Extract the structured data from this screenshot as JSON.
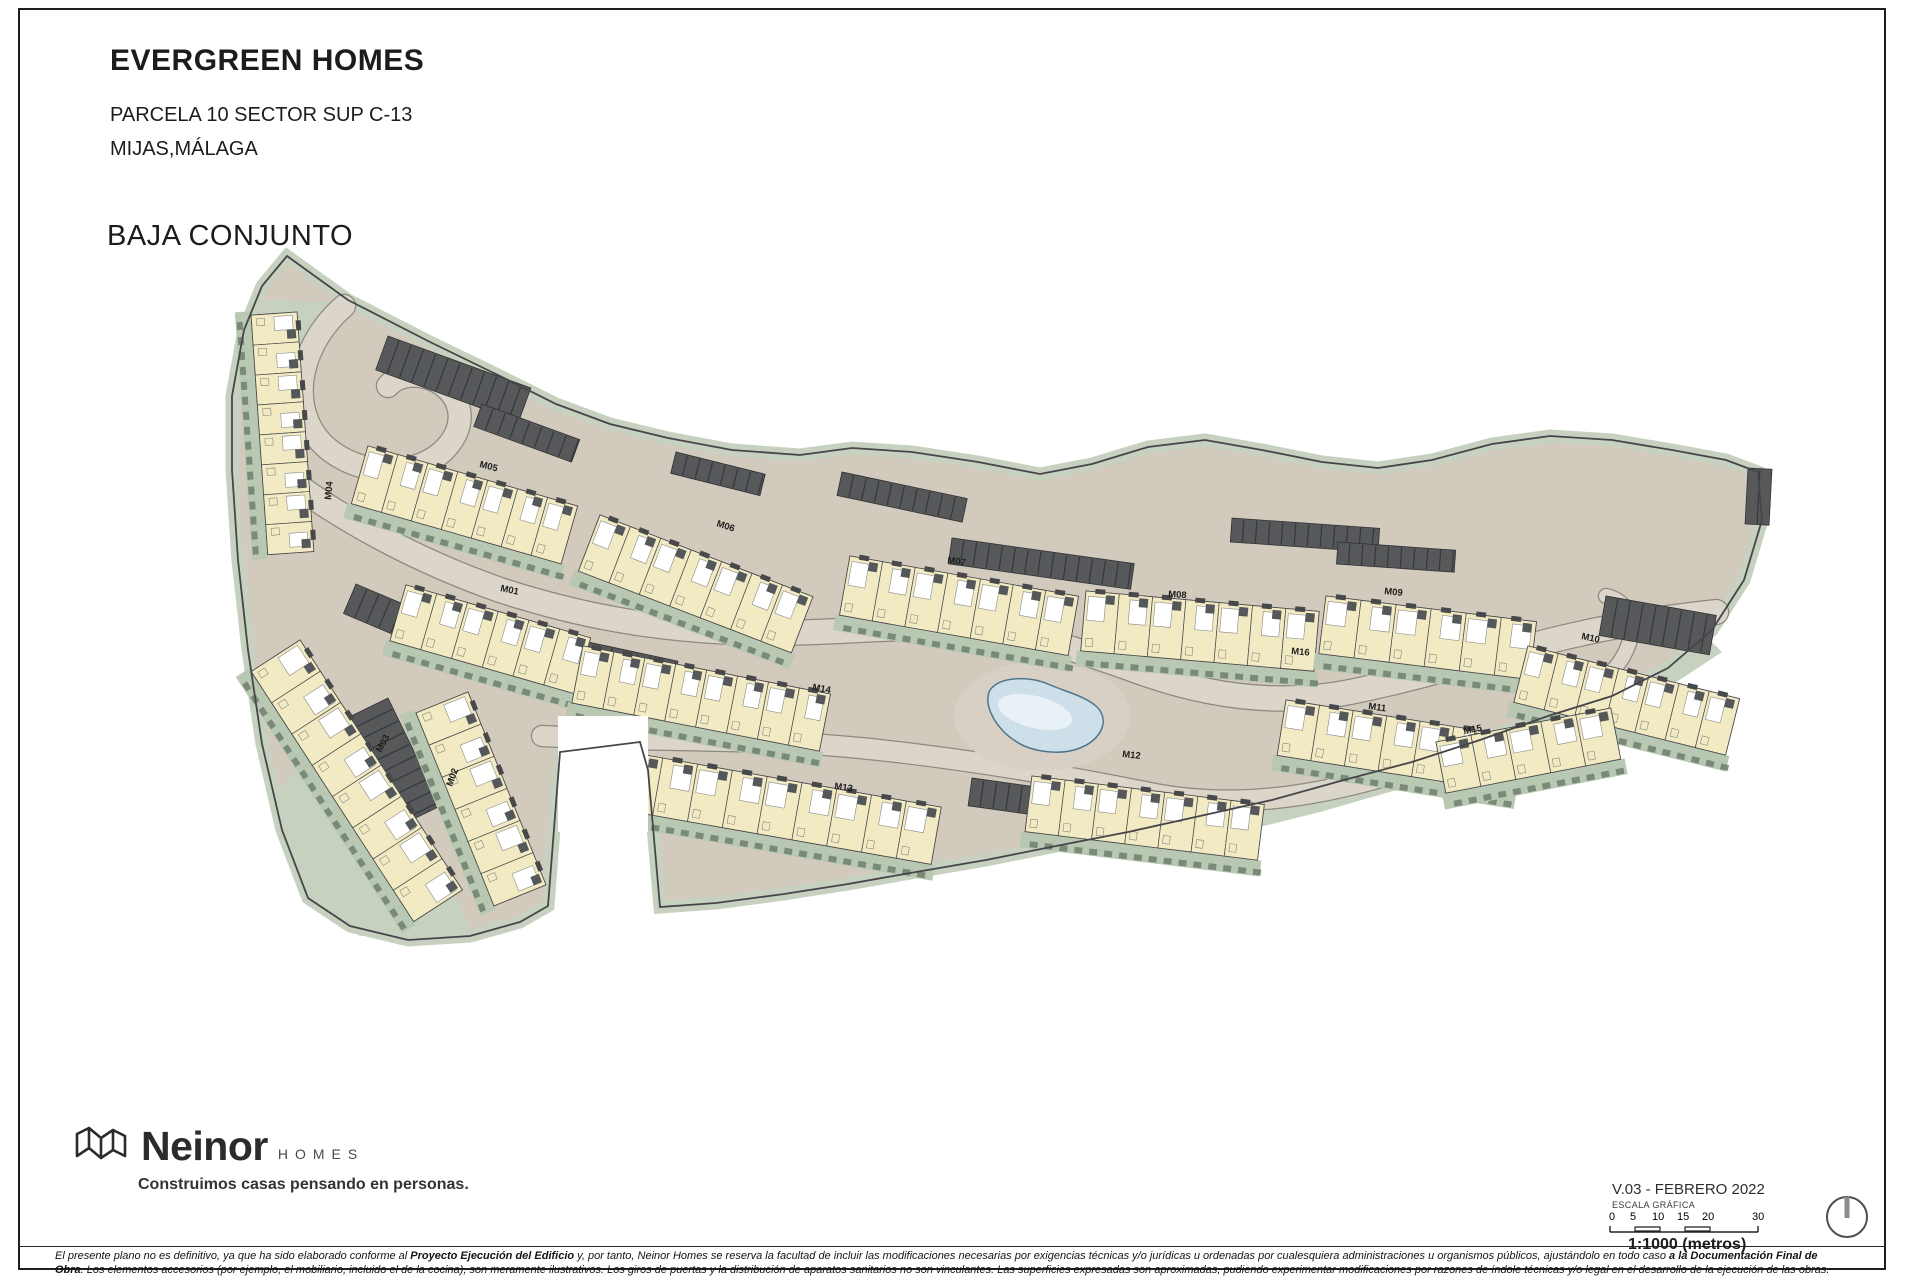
{
  "title_block": {
    "project": "EVERGREEN HOMES",
    "line1": "PARCELA 10 SECTOR SUP C-13",
    "line2": "MIJAS,MÁLAGA",
    "view": "BAJA CONJUNTO"
  },
  "footer": {
    "brand": "Neinor",
    "brand_sub": "HOMES",
    "tagline": "Construimos casas pensando en personas.",
    "version": "V.03 - FEBRERO 2022",
    "scale_title": "ESCALA GRÁFICA",
    "scale_marks": [
      "0",
      "5",
      "10",
      "15",
      "20",
      "30"
    ],
    "scale_ratio": "1:1000 (metros)",
    "compass_icon": "north-indicator"
  },
  "disclaimer": {
    "line1": [
      {
        "t": "El presente plano no es definitivo, ya que ha sido elaborado conforme al ",
        "b": false
      },
      {
        "t": "Proyecto Ejecución del Edificio",
        "b": true
      },
      {
        "t": " y, por tanto, Neinor Homes se reserva la facultad de incluir las modificaciones necesarias por exigencias técnicas y/o jurídicas u ordenadas por cualesquiera administraciones u organismos públicos, ajustándolo en todo caso ",
        "b": false
      },
      {
        "t": "a la Documentación Final de",
        "b": true
      }
    ],
    "line2": [
      {
        "t": "Obra",
        "b": true
      },
      {
        "t": ". Los elementos accesorios (por ejemplo, el mobiliario, incluido el de la cocina), son meramente ilustrativos. Los giros de puertas y la distribución de aparatos sanitarios no son vinculantes. Las superficies expresadas son aproximadas, pudiendo experimentar modificaciones por razones de índole técnicas y/o legal en el desarrollo de la ejecución de las obras.",
        "b": false
      }
    ]
  },
  "plan": {
    "colors": {
      "ground": "#d2cabd",
      "road": "#dcd5ca",
      "casing": "#8d897f",
      "green": "#b9c8b2",
      "green2": "#c6d2bf",
      "hedge": "#6f7f6d",
      "strip": "#fcfbf5",
      "unit": "#f1eac2",
      "line": "#46464a",
      "dark": "#56585a",
      "pool": "#cddfe9",
      "pool_edge": "#50758b"
    },
    "outline": [
      [
        287,
        256
      ],
      [
        348,
        300
      ],
      [
        430,
        342
      ],
      [
        500,
        376
      ],
      [
        556,
        404
      ],
      [
        610,
        424
      ],
      [
        668,
        438
      ],
      [
        732,
        450
      ],
      [
        800,
        455
      ],
      [
        852,
        448
      ],
      [
        912,
        452
      ],
      [
        978,
        462
      ],
      [
        1040,
        474
      ],
      [
        1092,
        464
      ],
      [
        1148,
        447
      ],
      [
        1205,
        440
      ],
      [
        1262,
        450
      ],
      [
        1322,
        462
      ],
      [
        1378,
        468
      ],
      [
        1432,
        460
      ],
      [
        1492,
        444
      ],
      [
        1550,
        436
      ],
      [
        1612,
        440
      ],
      [
        1672,
        450
      ],
      [
        1726,
        460
      ],
      [
        1758,
        472
      ],
      [
        1762,
        520
      ],
      [
        1744,
        580
      ],
      [
        1712,
        630
      ],
      [
        1668,
        668
      ],
      [
        1612,
        696
      ],
      [
        1548,
        716
      ],
      [
        1480,
        740
      ],
      [
        1412,
        762
      ],
      [
        1344,
        780
      ],
      [
        1272,
        800
      ],
      [
        1200,
        816
      ],
      [
        1128,
        832
      ],
      [
        1056,
        846
      ],
      [
        986,
        860
      ],
      [
        916,
        872
      ],
      [
        848,
        884
      ],
      [
        784,
        894
      ],
      [
        716,
        903
      ],
      [
        660,
        907
      ],
      [
        648,
        770
      ],
      [
        640,
        742
      ],
      [
        560,
        752
      ],
      [
        548,
        906
      ],
      [
        520,
        922
      ],
      [
        470,
        936
      ],
      [
        408,
        940
      ],
      [
        350,
        926
      ],
      [
        308,
        898
      ],
      [
        282,
        830
      ],
      [
        262,
        744
      ],
      [
        248,
        650
      ],
      [
        238,
        560
      ],
      [
        232,
        470
      ],
      [
        232,
        396
      ],
      [
        244,
        330
      ],
      [
        262,
        286
      ]
    ],
    "green_patches": [
      [
        [
          266,
          300
        ],
        [
          332,
          302
        ],
        [
          302,
          354
        ],
        [
          252,
          338
        ]
      ],
      [
        [
          300,
          762
        ],
        [
          420,
          820
        ],
        [
          470,
          930
        ],
        [
          360,
          936
        ],
        [
          302,
          894
        ],
        [
          272,
          800
        ]
      ],
      [
        [
          1150,
          838
        ],
        [
          1300,
          800
        ],
        [
          1460,
          752
        ],
        [
          1590,
          706
        ],
        [
          1680,
          662
        ],
        [
          1706,
          636
        ],
        [
          1722,
          652
        ],
        [
          1640,
          706
        ],
        [
          1480,
          766
        ],
        [
          1320,
          812
        ],
        [
          1160,
          852
        ]
      ]
    ],
    "roads": [
      {
        "d": "M 344,306 C 292,352 288,420 332,452 C 368,478 420,476 446,448 C 468,424 462,396 438,382 C 420,372 398,374 388,386",
        "w": 22
      },
      {
        "d": "M 276,470 C 340,520 420,562 500,590 C 580,616 650,628 730,632 C 810,636 880,626 950,628 C 1020,630 1080,650 1140,672 C 1210,697 1280,706 1350,692 C 1430,676 1500,652 1570,636 C 1630,622 1680,616 1716,612",
        "w": 24
      },
      {
        "d": "M 542,736 C 660,742 760,738 860,748 C 960,758 1060,775 1150,793 C 1240,811 1330,795 1420,765",
        "w": 20
      },
      {
        "d": "M 1560,700 C 1600,688 1622,668 1630,640 C 1636,616 1624,600 1606,596",
        "w": 14
      }
    ],
    "strips": [
      [
        388,
        336,
        152,
        36,
        20
      ],
      [
        482,
        404,
        104,
        24,
        20
      ],
      [
        356,
        584,
        206,
        32,
        23
      ],
      [
        388,
        698,
        120,
        44,
        64
      ],
      [
        588,
        642,
        92,
        46,
        12
      ],
      [
        842,
        472,
        128,
        24,
        12
      ],
      [
        676,
        452,
        92,
        22,
        14
      ],
      [
        952,
        538,
        184,
        26,
        8
      ],
      [
        1232,
        518,
        148,
        24,
        4
      ],
      [
        1338,
        542,
        118,
        22,
        4
      ],
      [
        1606,
        596,
        112,
        40,
        10
      ],
      [
        1748,
        468,
        24,
        56,
        3
      ],
      [
        972,
        778,
        122,
        28,
        8
      ]
    ],
    "rows": [
      [
        297,
        312,
        240,
        46,
        86,
        8
      ],
      [
        368,
        446,
        218,
        60,
        16,
        7
      ],
      [
        600,
        515,
        228,
        60,
        21,
        7
      ],
      [
        850,
        556,
        232,
        60,
        10,
        7
      ],
      [
        1086,
        591,
        234,
        60,
        5,
        7
      ],
      [
        1326,
        596,
        212,
        58,
        7,
        6
      ],
      [
        1528,
        646,
        218,
        58,
        14,
        7
      ],
      [
        406,
        585,
        192,
        58,
        16,
        6
      ],
      [
        583,
        646,
        252,
        58,
        11,
        8
      ],
      [
        1286,
        700,
        238,
        56,
        9,
        7
      ],
      [
        628,
        752,
        318,
        58,
        10,
        9
      ],
      [
        1032,
        776,
        234,
        56,
        7,
        7
      ],
      [
        468,
        692,
        208,
        56,
        68,
        6
      ],
      [
        300,
        640,
        298,
        58,
        57,
        8
      ],
      [
        1436,
        742,
        178,
        52,
        -11,
        5
      ]
    ],
    "labels": [
      {
        "text": "M01",
        "x": 500,
        "y": 591,
        "r": 12
      },
      {
        "text": "M02",
        "x": 452,
        "y": 787,
        "r": -70
      },
      {
        "text": "M03",
        "x": 381,
        "y": 753,
        "r": -62
      },
      {
        "text": "M04",
        "x": 331,
        "y": 500,
        "r": -85
      },
      {
        "text": "M05",
        "x": 479,
        "y": 467,
        "r": 14
      },
      {
        "text": "M06",
        "x": 716,
        "y": 526,
        "r": 18
      },
      {
        "text": "M07",
        "x": 947,
        "y": 563,
        "r": 8
      },
      {
        "text": "M08",
        "x": 1168,
        "y": 597,
        "r": 4
      },
      {
        "text": "M09",
        "x": 1384,
        "y": 594,
        "r": 6
      },
      {
        "text": "M10",
        "x": 1581,
        "y": 639,
        "r": 12
      },
      {
        "text": "M11",
        "x": 1368,
        "y": 709,
        "r": 8
      },
      {
        "text": "M12",
        "x": 1122,
        "y": 757,
        "r": 6
      },
      {
        "text": "M13",
        "x": 834,
        "y": 789,
        "r": 8
      },
      {
        "text": "M14",
        "x": 812,
        "y": 690,
        "r": 10
      },
      {
        "text": "M15",
        "x": 1464,
        "y": 734,
        "r": -10
      },
      {
        "text": "M16",
        "x": 1291,
        "y": 654,
        "r": 5
      }
    ],
    "pool": {
      "deck": {
        "cx": 1042,
        "cy": 716,
        "rx": 88,
        "ry": 55
      },
      "d": "M 990,690 C 1000,676 1030,676 1048,684 C 1066,692 1086,696 1098,708 C 1110,722 1100,740 1080,748 C 1060,756 1030,752 1014,740 C 998,730 982,706 990,690 Z"
    },
    "white_patch": [
      558,
      716,
      90,
      116
    ]
  }
}
